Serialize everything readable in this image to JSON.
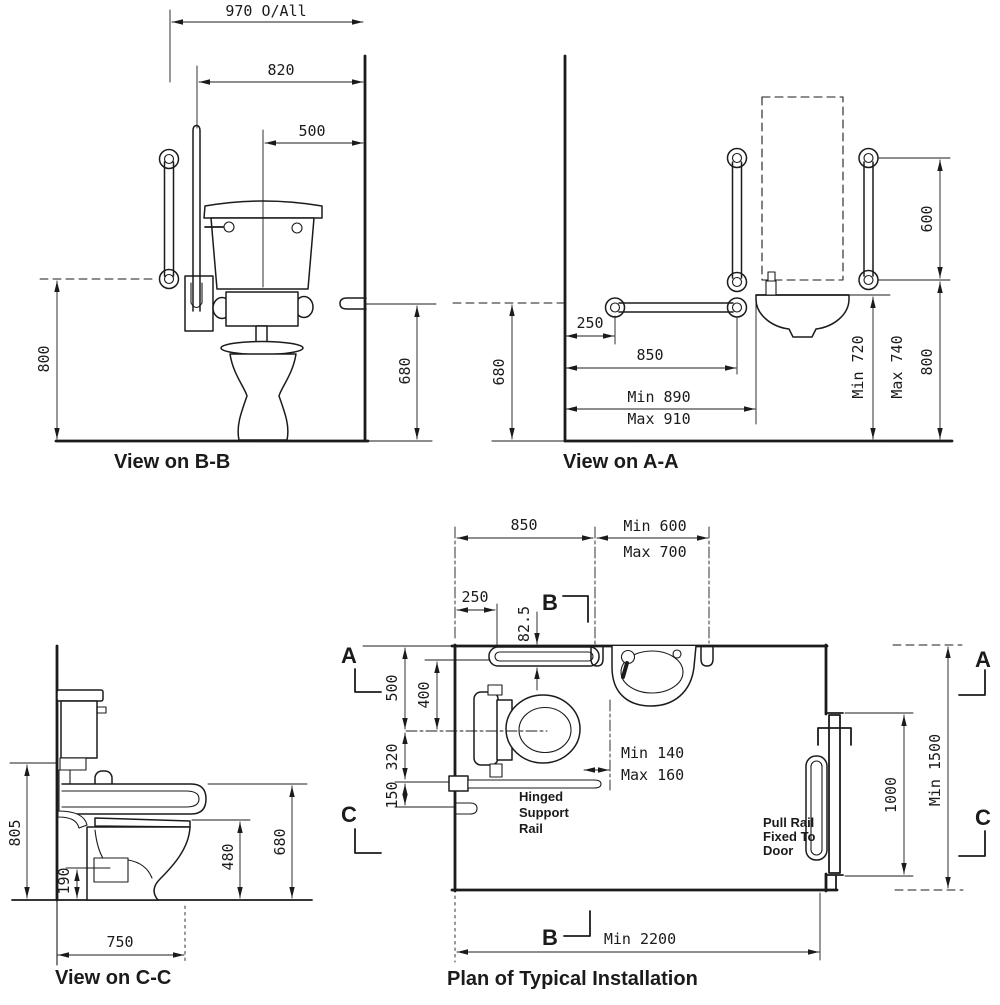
{
  "drawing": {
    "paper": "#ffffff",
    "ink": "#1b1b1b"
  },
  "view_bb": {
    "title": "View on B-B",
    "dim_970": "970 O/All",
    "dim_820": "820",
    "dim_500": "500",
    "dim_800": "800",
    "dim_680": "680"
  },
  "view_aa": {
    "title": "View on A-A",
    "dim_250": "250",
    "dim_850": "850",
    "dim_min890": "Min 890",
    "dim_max910": "Max 910",
    "dim_680": "680",
    "dim_min720": "Min 720",
    "dim_max740": "Max 740",
    "dim_800": "800",
    "dim_600": "600"
  },
  "view_cc": {
    "title": "View on C-C",
    "dim_805": "805",
    "dim_190": "190",
    "dim_480": "480",
    "dim_680": "680",
    "dim_750": "750"
  },
  "plan": {
    "title": "Plan of Typical Installation",
    "dim_850": "850",
    "dim_min600": "Min 600",
    "dim_max700": "Max 700",
    "dim_250": "250",
    "dim_82_5": "82.5",
    "dim_500": "500",
    "dim_400": "400",
    "dim_320": "320",
    "dim_150": "150",
    "dim_min140": "Min 140",
    "dim_max160": "Max 160",
    "dim_1000": "1000",
    "dim_min1500": "Min 1500",
    "dim_min2200": "Min 2200",
    "label_hinged_1": "Hinged",
    "label_hinged_2": "Support",
    "label_hinged_3": "Rail",
    "label_pull_1": "Pull Rail",
    "label_pull_2": "Fixed To",
    "label_pull_3": "Door",
    "marker_a": "A",
    "marker_b": "B",
    "marker_c": "C"
  }
}
